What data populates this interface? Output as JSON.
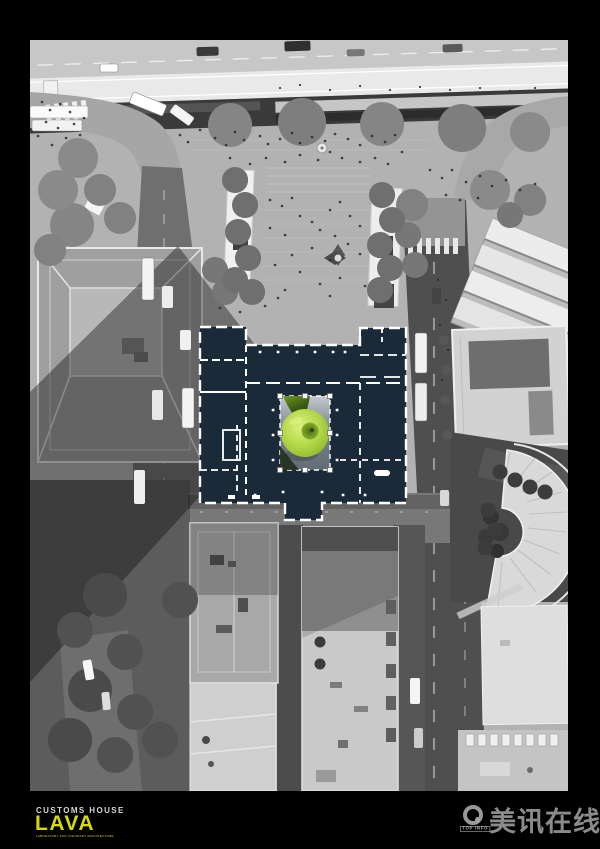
{
  "poster": {
    "background": "#000000"
  },
  "footer": {
    "project_label": "CUSTOMS HOUSE",
    "brand": "LAVA",
    "brand_tagline": "LABORATORY FOR VISIONARY ARCHITECTURE",
    "brand_color": "#d6da00"
  },
  "watermark": {
    "logo": "ring-a-icon",
    "top_info": "TOP INFO",
    "site_name": "美讯在线"
  },
  "overlay": {
    "plan_fill": "#1b2a38",
    "wall_color": "#ffffff",
    "apple_green": "#a9cc3e",
    "selection_handles": 8
  }
}
